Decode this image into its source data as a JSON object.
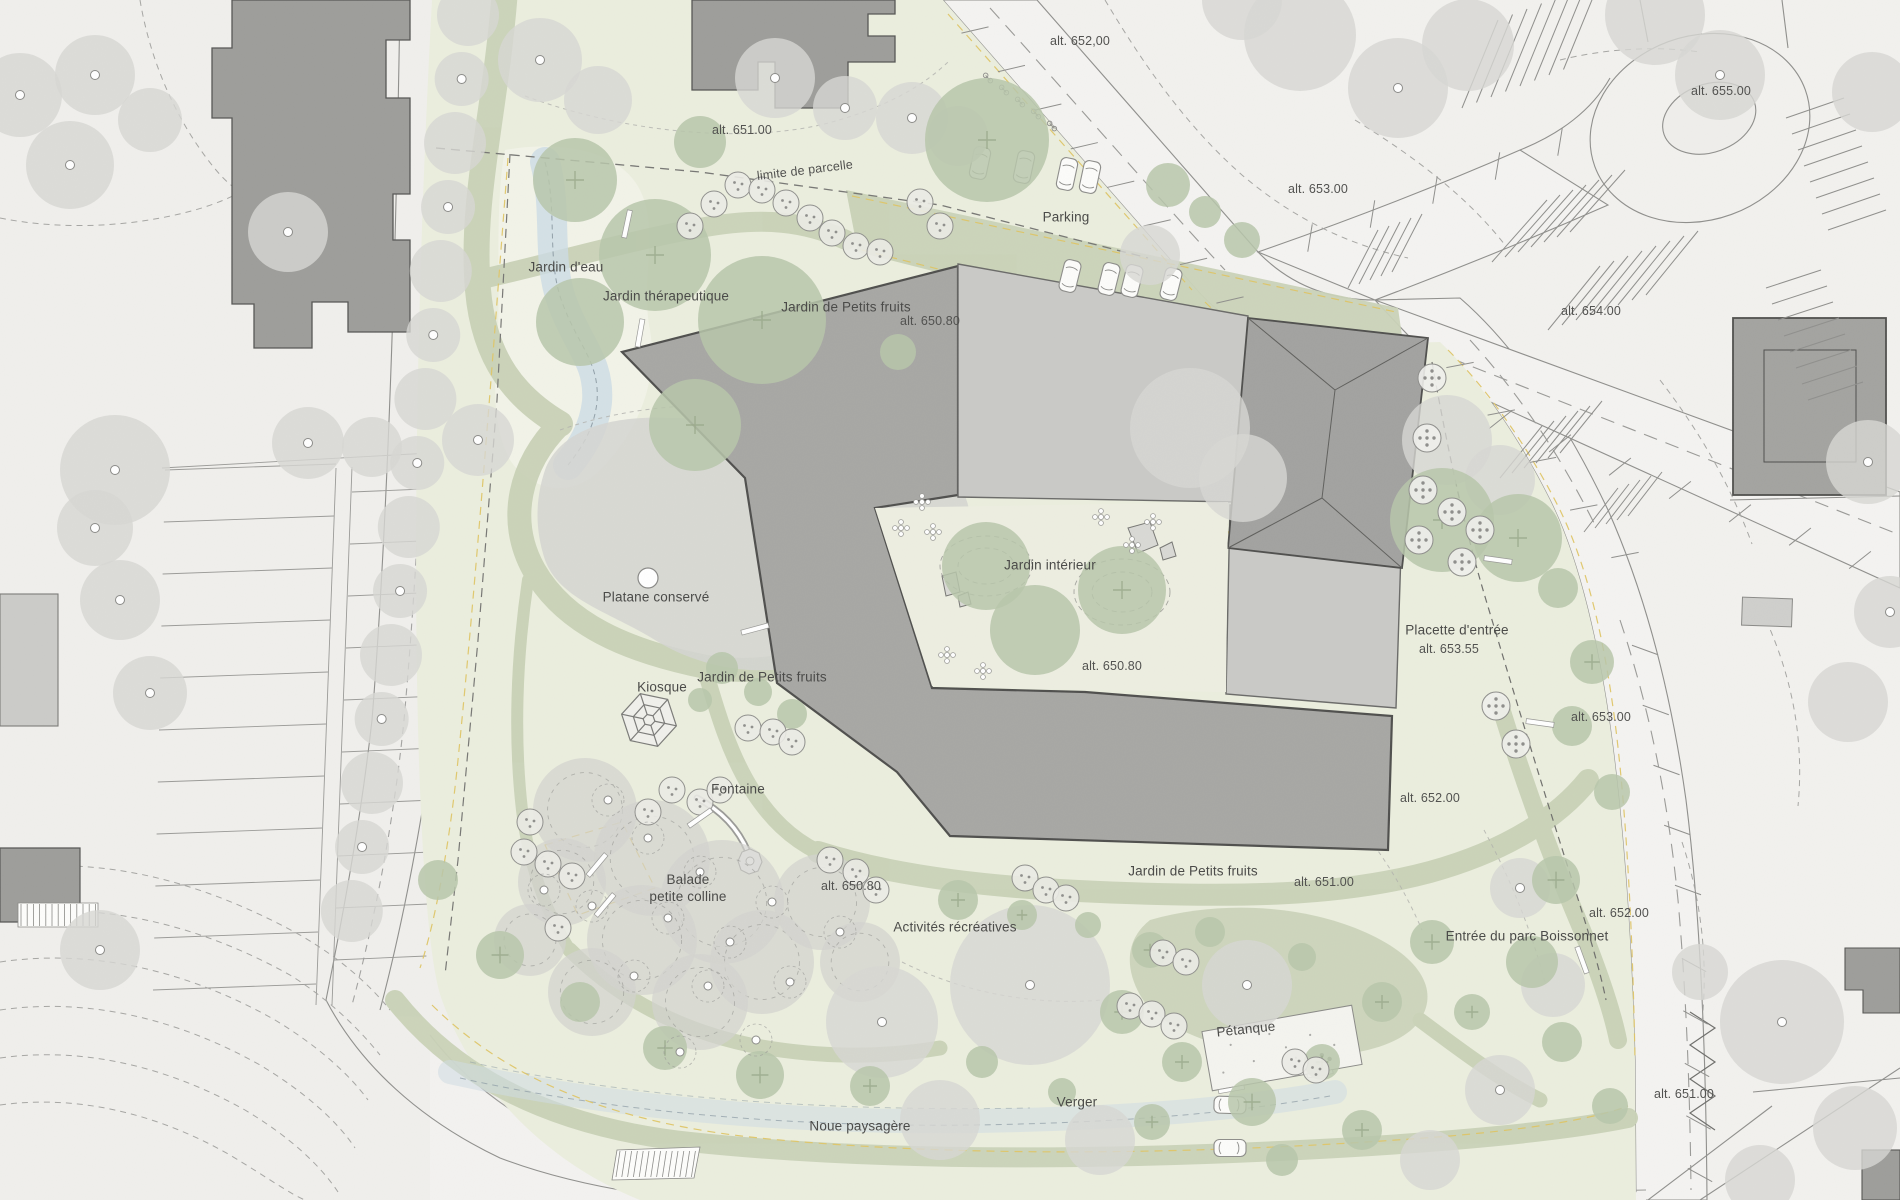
{
  "colors": {
    "context_bg": "#f0efec",
    "context_ne_bg": "#f2f1ee",
    "road_fill": "#f4f3f1",
    "park_fill": "#ebeede",
    "park_light": "#f2f3e8",
    "path_green": "#c9d2b7",
    "canopy_green": "#b7c6aa",
    "tree_gray": "#d7d7d3",
    "mound_gray": "#d5d5d1",
    "building_dark": "#a7a7a4",
    "building_light": "#c9c9c6",
    "context_building": "#9d9d9a",
    "outline_dark": "#4f4f4d",
    "water_blue": "#ccdce5",
    "dash_yellow": "#dfc566",
    "label_color": "#4b4b49"
  },
  "labels": {
    "alt_652_top": "alt. 652,00",
    "alt_655": "alt. 655.00",
    "alt_651_top": "alt. 651.00",
    "limite_de_parcelle": "limite de parcelle",
    "alt_653_top": "alt. 653.00",
    "parking": "Parking",
    "alt_654": "alt. 654.00",
    "jardin_eau": "Jardin d'eau",
    "jardin_therapeutique": "Jardin thérapeutique",
    "alt_650_80_a": "alt. 650.80",
    "petits_fruits_top": "Jardin de Petits fruits",
    "jardin_interieur": "Jardin intérieur",
    "platane": "Platane conservé",
    "alt_650_80_b": "alt. 650.80",
    "placette": "Placette d'entrée",
    "alt_653_55": "alt. 653.55",
    "kiosque": "Kiosque",
    "petits_fruits_mid": "Jardin de Petits fruits",
    "alt_653_right": "alt. 653.00",
    "fontaine": "Fontaine",
    "alt_652_right": "alt. 652.00",
    "balade": "Balade\npetite colline",
    "alt_650_80_c": "alt. 650.80",
    "petits_fruits_bottom": "Jardin de Petits fruits",
    "alt_651_bottom": "alt. 651.00",
    "alt_652_road": "alt. 652.00",
    "activites": "Activités récréatives",
    "entree": "Entrée du parc Boissonnet",
    "petanque": "Pétanque",
    "verger": "Verger",
    "alt_651_se": "alt. 651.00",
    "noue": "Noue paysagère"
  }
}
